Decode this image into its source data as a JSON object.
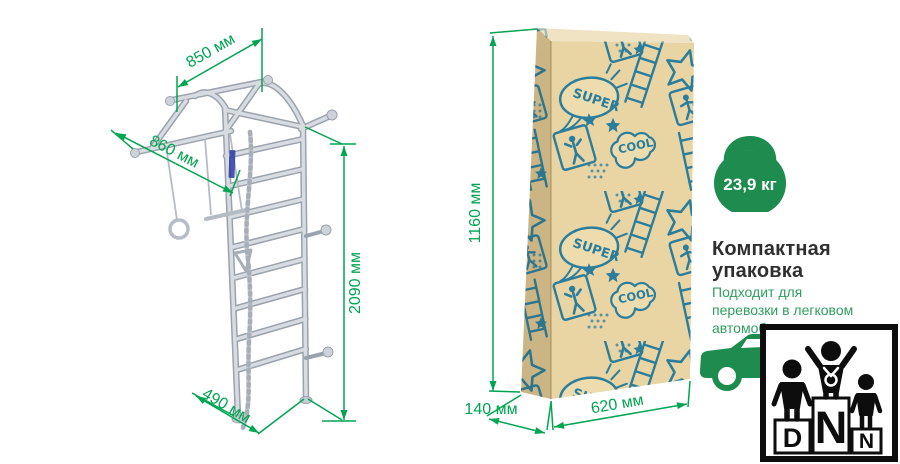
{
  "colors": {
    "accent_green": "#00A551",
    "badge_green": "#1E8C4E",
    "body_text_green": "#2F9E5F",
    "heading_text": "#2F2F2F",
    "kraft_front": "#E9D4A4",
    "kraft_side": "#DCC492",
    "kraft_top": "#F0E3C4",
    "pattern_teal": "#2B7D9C",
    "drawing_gray": "#D8DCE1",
    "logo_black": "#0D0D0D"
  },
  "ladder_drawing": {
    "dim_top_width": "850 мм",
    "dim_depth": "860 мм",
    "dim_height": "2090 мм",
    "dim_base_depth": "490 мм"
  },
  "package_box": {
    "dim_height": "1160 мм",
    "dim_depth": "140 мм",
    "dim_width": "620 мм",
    "art_super": "SUPER",
    "art_cool": "COOL"
  },
  "weight_badge": {
    "label": "23,9 кг"
  },
  "info_block": {
    "title_lines": [
      "Компактная",
      "упаковка"
    ],
    "body_lines": [
      "Подходит для",
      "перевозки в легковом",
      "автомобиле"
    ]
  },
  "logo": {
    "letter_left": "D",
    "letter_center": "N",
    "letter_right": "N"
  }
}
